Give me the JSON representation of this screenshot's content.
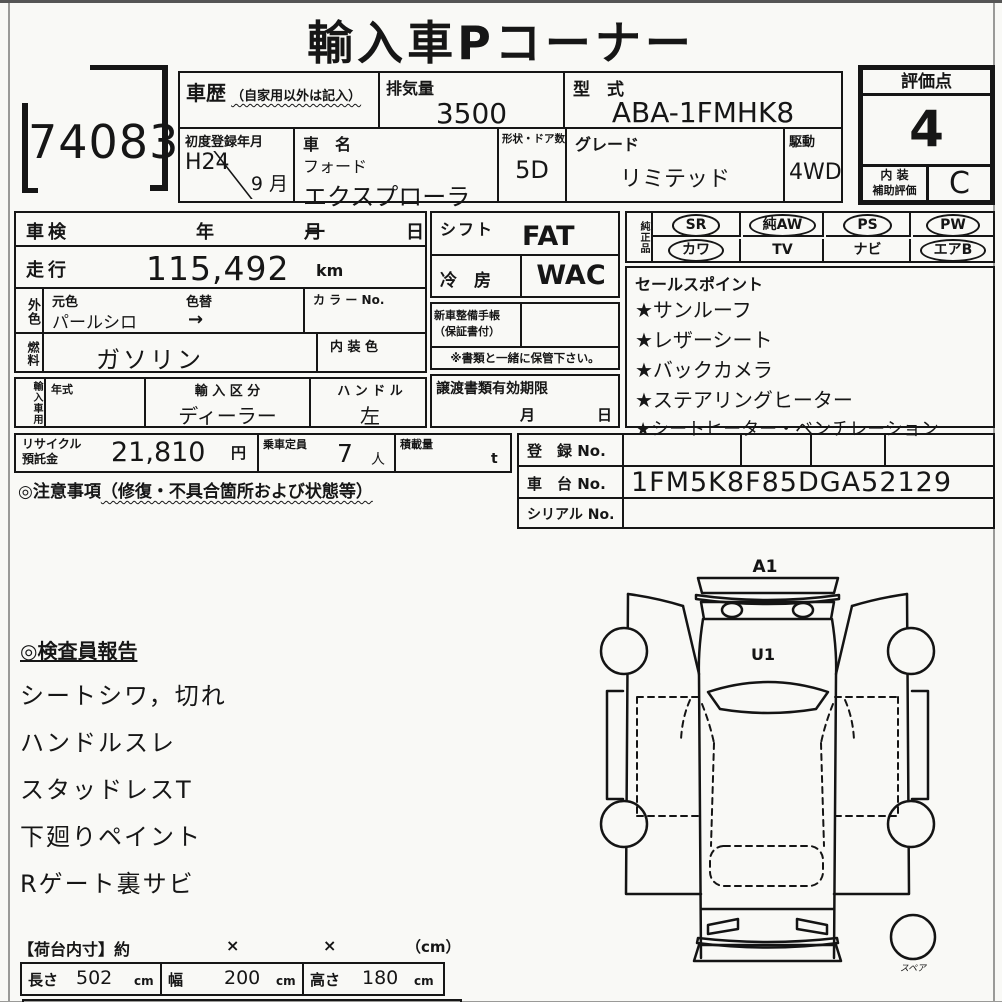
{
  "title": "輸入車Pコーナー",
  "lot": "74083",
  "header": {
    "history": {
      "label": "車歴",
      "note": "（自家用以外は記入）"
    },
    "displacement": {
      "label": "排気量",
      "value": "3500"
    },
    "model_code": {
      "label": "型　式",
      "value": "ABA-1FMHK8"
    },
    "first_reg": {
      "label": "初度登録年月",
      "year": "H24",
      "month": "9 月"
    },
    "car_name": {
      "label": "車　名",
      "maker": "フォード",
      "model": "エクスプローラー"
    },
    "body": {
      "label": "形状・ドア数",
      "value": "5D"
    },
    "grade": {
      "label": "グレード",
      "value": "リミテッド"
    },
    "drive": {
      "label": "駆動",
      "value": "4WD"
    },
    "score": {
      "label": "評価点",
      "value": "4",
      "int_label1": "内 装",
      "int_label2": "補助評価",
      "int_value": "C"
    }
  },
  "left": {
    "shaken": {
      "label": "車検",
      "y": "年",
      "m": "月",
      "d": "日"
    },
    "mileage": {
      "label": "走行",
      "value": "115,492",
      "unit": "km"
    },
    "exterior": {
      "label": "外色",
      "orig": "元色",
      "repaint": "色替",
      "value": "パールシロ",
      "arrow": "→",
      "color_no": "カ ラ ー No."
    },
    "fuel": {
      "label": "燃料",
      "value": "ガソリン",
      "interior": "内 装 色"
    },
    "importer": {
      "label": "輸入車用",
      "year_label": "年式",
      "category_label": "輸 入 区 分",
      "category": "ディーラー",
      "handle_label": "ハ ン ド ル",
      "handle": "左"
    },
    "recycle": {
      "l1": "リサイクル",
      "l2": "預託金",
      "value": "21,810",
      "unit": "円",
      "cap_label": "乗車定員",
      "cap": "7",
      "cap_unit": "人",
      "load_label": "積載量",
      "load_unit": "t"
    },
    "caution": {
      "prefix": "◎注意事項",
      "note": "（修復・不具合箇所および状態等）"
    },
    "inspector": {
      "title": "◎検査員報告",
      "items": [
        "シートシワ，切れ",
        "ハンドルスレ",
        "スタッドレスT",
        "下廻りペイント",
        "Rゲート裏サビ"
      ]
    }
  },
  "mid": {
    "shift": {
      "label": "シフト",
      "value": "FAT"
    },
    "ac": {
      "label": "冷　房",
      "value": "WAC"
    },
    "book": {
      "l1": "新車整備手帳",
      "l2": "（保証書付）",
      "note": "※書類と一緒に保管下さい。"
    },
    "transfer": {
      "label": "譲渡書類有効期限",
      "m": "月",
      "d": "日"
    }
  },
  "equip": {
    "label": "純正品",
    "row1": [
      {
        "text": "SR",
        "circled": true
      },
      {
        "text": "純AW",
        "circled": true
      },
      {
        "text": "PS",
        "circled": true
      },
      {
        "text": "PW",
        "circled": true
      }
    ],
    "row2": [
      {
        "text": "カワ",
        "circled": true
      },
      {
        "text": "TV",
        "circled": false
      },
      {
        "text": "ナビ",
        "circled": false
      },
      {
        "text": "エアB",
        "circled": true
      }
    ]
  },
  "sales": {
    "title": "セールスポイント",
    "items": [
      "★サンルーフ",
      "★レザーシート",
      "★バックカメラ",
      "★ステアリングヒーター",
      "★シートヒーター・ベンチレーション"
    ]
  },
  "numbers": {
    "reg_label": "登　録 No.",
    "chassis_label": "車　台 No.",
    "chassis_value": "1FM5K8F85DGA52129",
    "serial_label": "シリアル No."
  },
  "diagram": {
    "a1": "A1",
    "u1": "U1",
    "spare": "スペア"
  },
  "dims": {
    "title": "【荷台内寸】約",
    "x1": "×",
    "x2": "×",
    "unit": "（cm）",
    "cells": [
      {
        "label": "長さ",
        "value": "502",
        "unit": "cm"
      },
      {
        "label": "幅",
        "value": "200",
        "unit": "cm"
      },
      {
        "label": "高さ",
        "value": "180",
        "unit": "cm"
      }
    ]
  },
  "colors": {
    "ink": "#161616",
    "paper": "#f9f9f6"
  }
}
